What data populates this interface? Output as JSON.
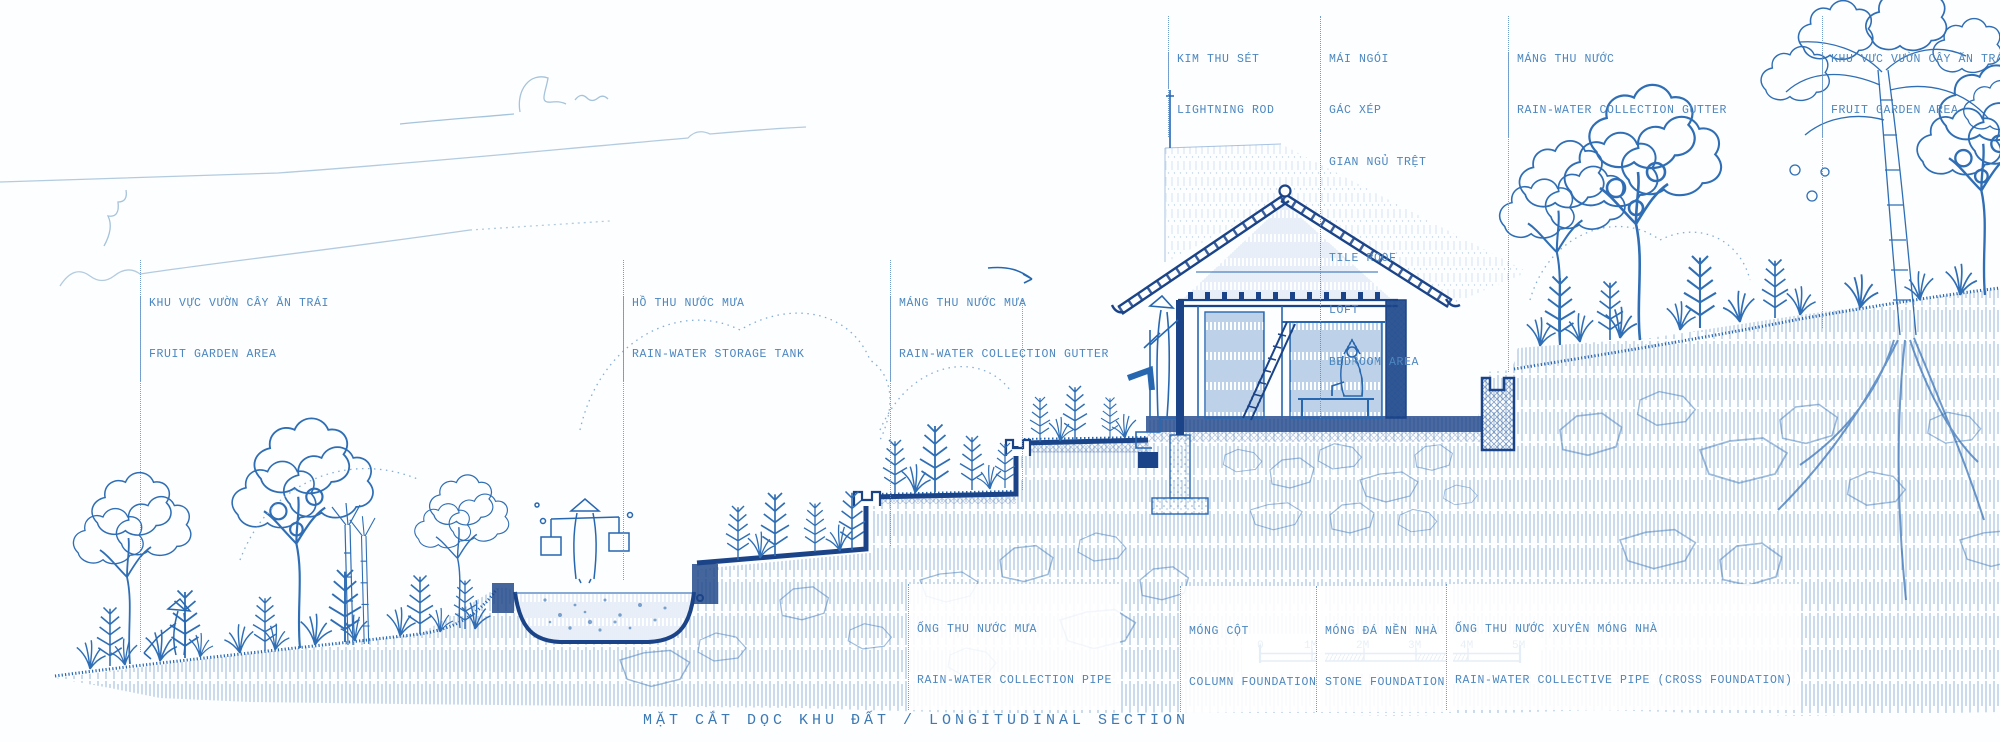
{
  "drawing": {
    "title": "MẶT CẮT DỌC KHU ĐẤT / LONGITUDINAL SECTION"
  },
  "labels": {
    "fruit_garden_left": {
      "vi": "KHU VỰC VƯỜN CÂY ĂN TRÁI",
      "en": "FRUIT GARDEN AREA"
    },
    "storage_tank": {
      "vi": "HỒ THU NƯỚC MƯA",
      "en": "RAIN-WATER STORAGE TANK"
    },
    "gutter_mid": {
      "vi": "MÁNG THU NƯỚC MƯA",
      "en": "RAIN-WATER COLLECTION GUTTER"
    },
    "lightning_rod": {
      "vi": "KIM THU SÉT",
      "en": "LIGHTNING ROD"
    },
    "roof_block": {
      "vi1": "MÁI NGÓI",
      "vi2": "GÁC XÉP",
      "vi3": "GIAN NGỦ TRỆT",
      "en1": "TILE ROOF",
      "en2": "LOFT",
      "en3": "BEDROOM AREA"
    },
    "gutter_top": {
      "vi": "MÁNG THU NƯỚC",
      "en": "RAIN-WATER COLLECTION GUTTER"
    },
    "fruit_garden_right": {
      "vi": "KHU VỰC VƯỜN CÂY ĂN TRÁI",
      "en": "FRUIT GARDEN AREA"
    },
    "collection_pipe": {
      "vi": "ỐNG THU NƯỚC MƯA",
      "en": "RAIN-WATER COLLECTION PIPE"
    },
    "column_foundation": {
      "vi": "MÓNG CỘT",
      "en": "COLUMN FOUNDATION"
    },
    "stone_foundation": {
      "vi": "MÓNG ĐÁ NỀN NHÀ",
      "en": "STONE FOUNDATION"
    },
    "cross_pipe": {
      "vi": "ỐNG THU NƯỚC XUYÊN MÓNG NHÀ",
      "en": "RAIN-WATER COLLECTIVE PIPE (CROSS FOUNDATION)"
    }
  },
  "scale_bar": {
    "labels": [
      "0",
      "1M",
      "2M",
      "3M",
      "4M",
      "5M"
    ]
  },
  "colors": {
    "ink": "#2767b0",
    "ink_dark": "#1b4488",
    "ink_light": "#7fa9d2",
    "sky_line": "#aac7de",
    "label_text": "#4c87bf",
    "paper": "#ffffff"
  }
}
